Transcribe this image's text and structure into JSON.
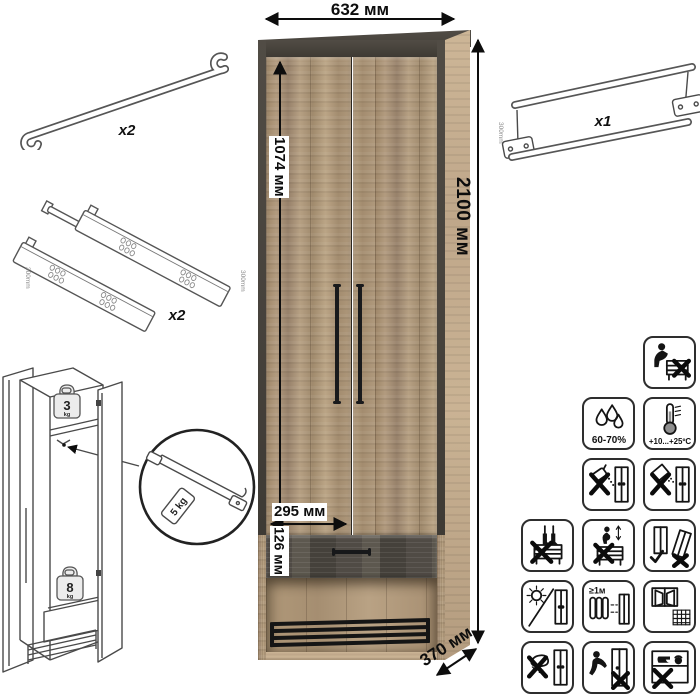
{
  "dimensions": {
    "width": "632 мм",
    "height": "2100 мм",
    "door_height": "1074 мм",
    "inner_width": "295 мм",
    "drawer_height": "126 мм",
    "depth": "370 мм"
  },
  "parts": {
    "door_handles": {
      "qty": "x2"
    },
    "drawer_slides": {
      "qty": "x2",
      "size": "300mm"
    },
    "hanger_rail": {
      "qty": "x1",
      "size": "300mm"
    }
  },
  "load_limits": {
    "shelf_value": "3",
    "shelf_unit": "kg",
    "rail_tag": "5 kg",
    "drawer_value": "8",
    "drawer_unit": "kg"
  },
  "care_icons": [
    {
      "name": "no-sitting-on-furniture",
      "label": ""
    },
    {
      "name": "humidity-range",
      "label": "60-70%"
    },
    {
      "name": "temperature-range",
      "label": "+10...+25ºC"
    },
    {
      "name": "no-liquids",
      "label": ""
    },
    {
      "name": "no-abrasive-powders",
      "label": ""
    },
    {
      "name": "no-standing-on-furniture",
      "label": ""
    },
    {
      "name": "no-jumping-on-furniture",
      "label": ""
    },
    {
      "name": "transport-upright",
      "label": ""
    },
    {
      "name": "no-direct-sunlight",
      "label": ""
    },
    {
      "name": "distance-from-heaters",
      "label": "≥1м"
    },
    {
      "name": "ventilated-dry-room",
      "label": ""
    },
    {
      "name": "no-wet-cleaning",
      "label": ""
    },
    {
      "name": "no-pushing-dragging",
      "label": ""
    },
    {
      "name": "no-heavy-objects",
      "label": ""
    }
  ]
}
